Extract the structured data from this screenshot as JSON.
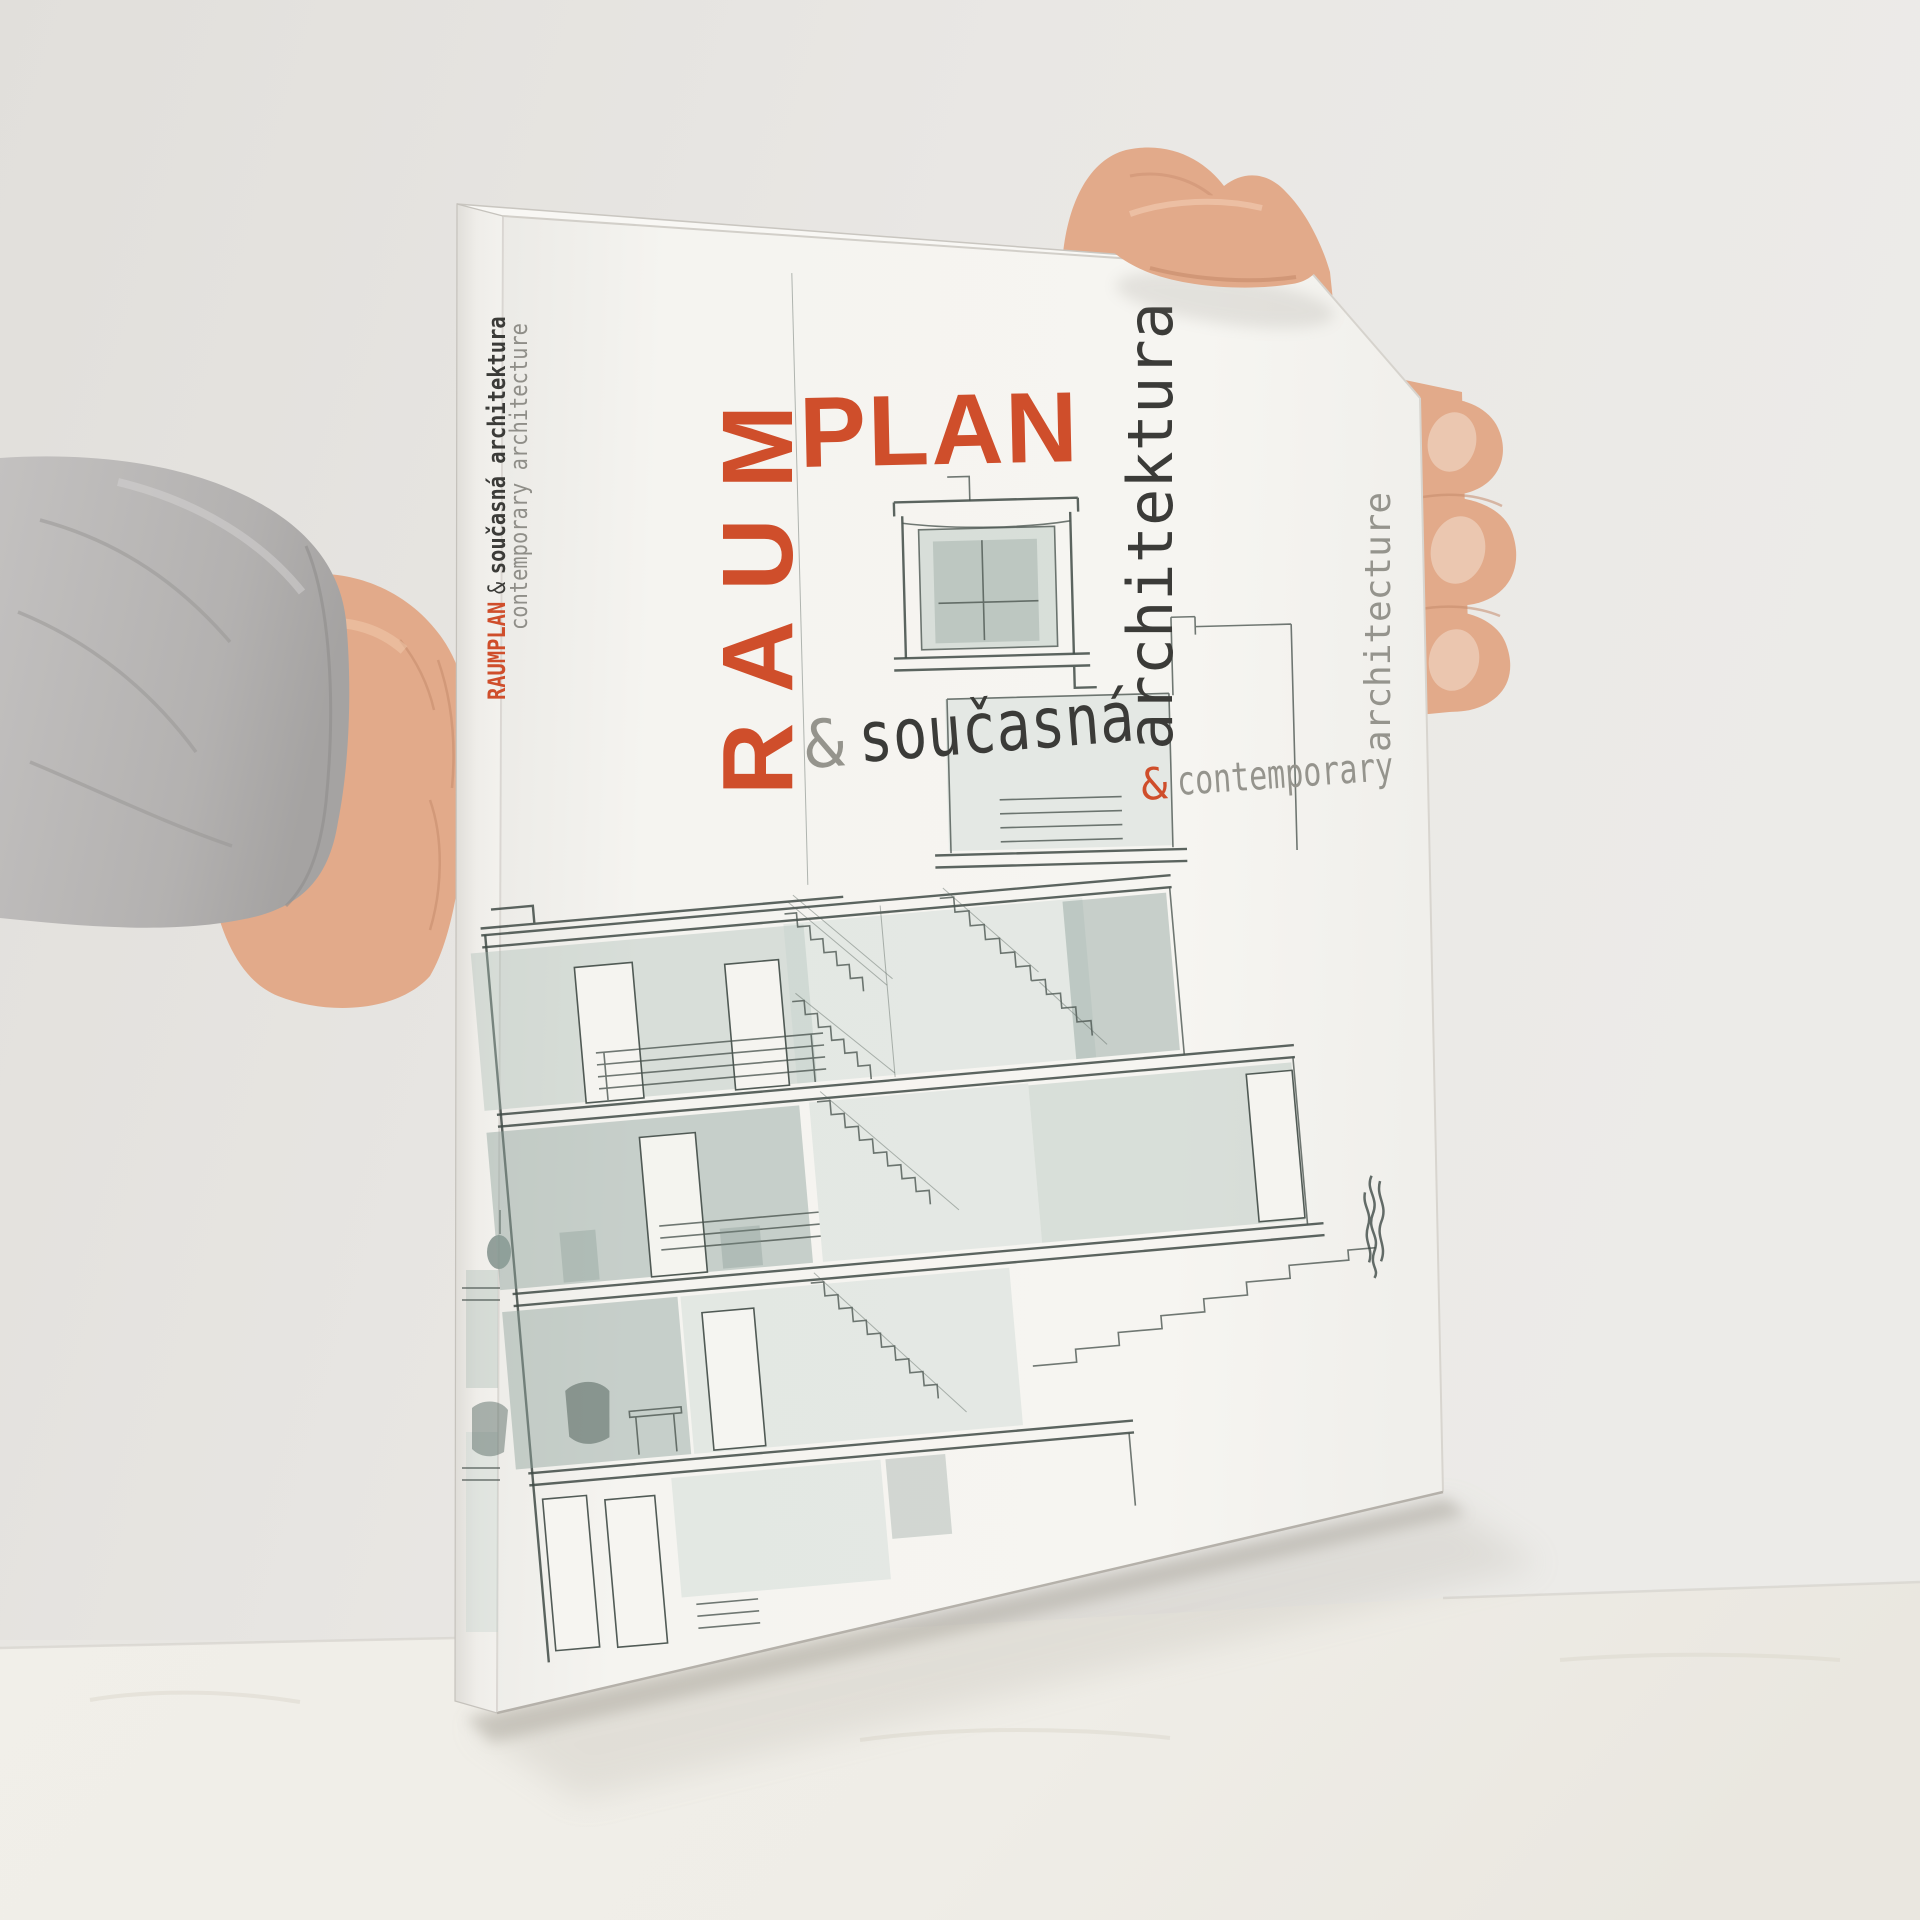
{
  "cover": {
    "title_line_vertical": "RAUM",
    "title_line_horizontal": "PLAN",
    "subtitle_cz": {
      "amp": "&",
      "word": "současná",
      "vertical": "architektura"
    },
    "subtitle_en": {
      "amp": "&",
      "word": "contemporary",
      "vertical": "architecture"
    }
  },
  "spine": {
    "title": "RAUMPLAN",
    "amp": "&",
    "subtitle_cz": "současná architektura",
    "subtitle_en": "contemporary architecture"
  },
  "colors": {
    "accent_red": "#cf4e2b",
    "ink_dark": "#3b3b38",
    "ink_grey": "#95948d",
    "wash_sage": "#9fb1ab",
    "cover_white": "#f4f3ef",
    "wall_grey": "#e8e6e2"
  }
}
